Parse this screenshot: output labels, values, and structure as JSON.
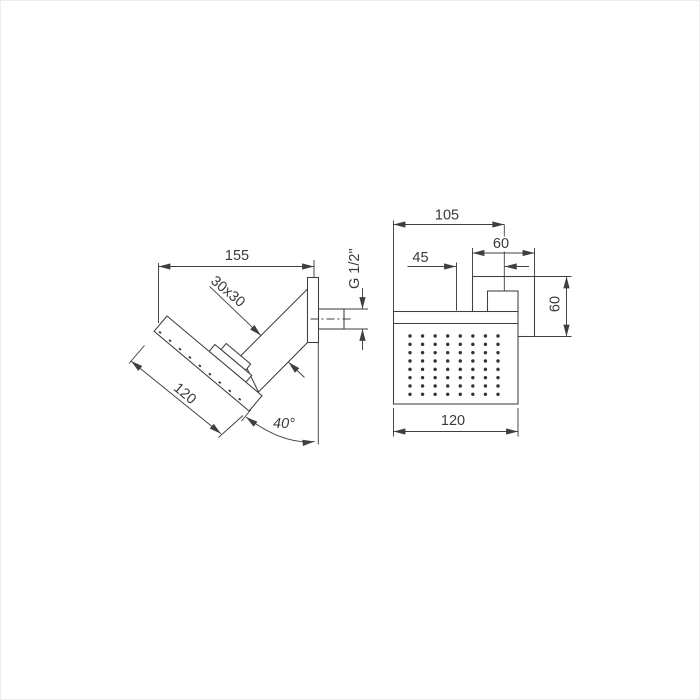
{
  "drawing_title": "Shower head technical dimension drawing",
  "side_view": {
    "labels": {
      "overall_width": "155",
      "arm_section": "30x30",
      "head_length": "120",
      "tilt_angle": "40°",
      "thread": "G 1/2\""
    }
  },
  "front_view": {
    "labels": {
      "arm_offset": "105",
      "flange_width": "60",
      "center_to_arm": "45",
      "flange_height": "60",
      "head_width": "120"
    },
    "nozzles": {
      "rows": 8,
      "cols": 8
    }
  },
  "colors": {
    "line": "#3f3f3f",
    "text": "#3a3a3a",
    "background": "#ffffff"
  }
}
